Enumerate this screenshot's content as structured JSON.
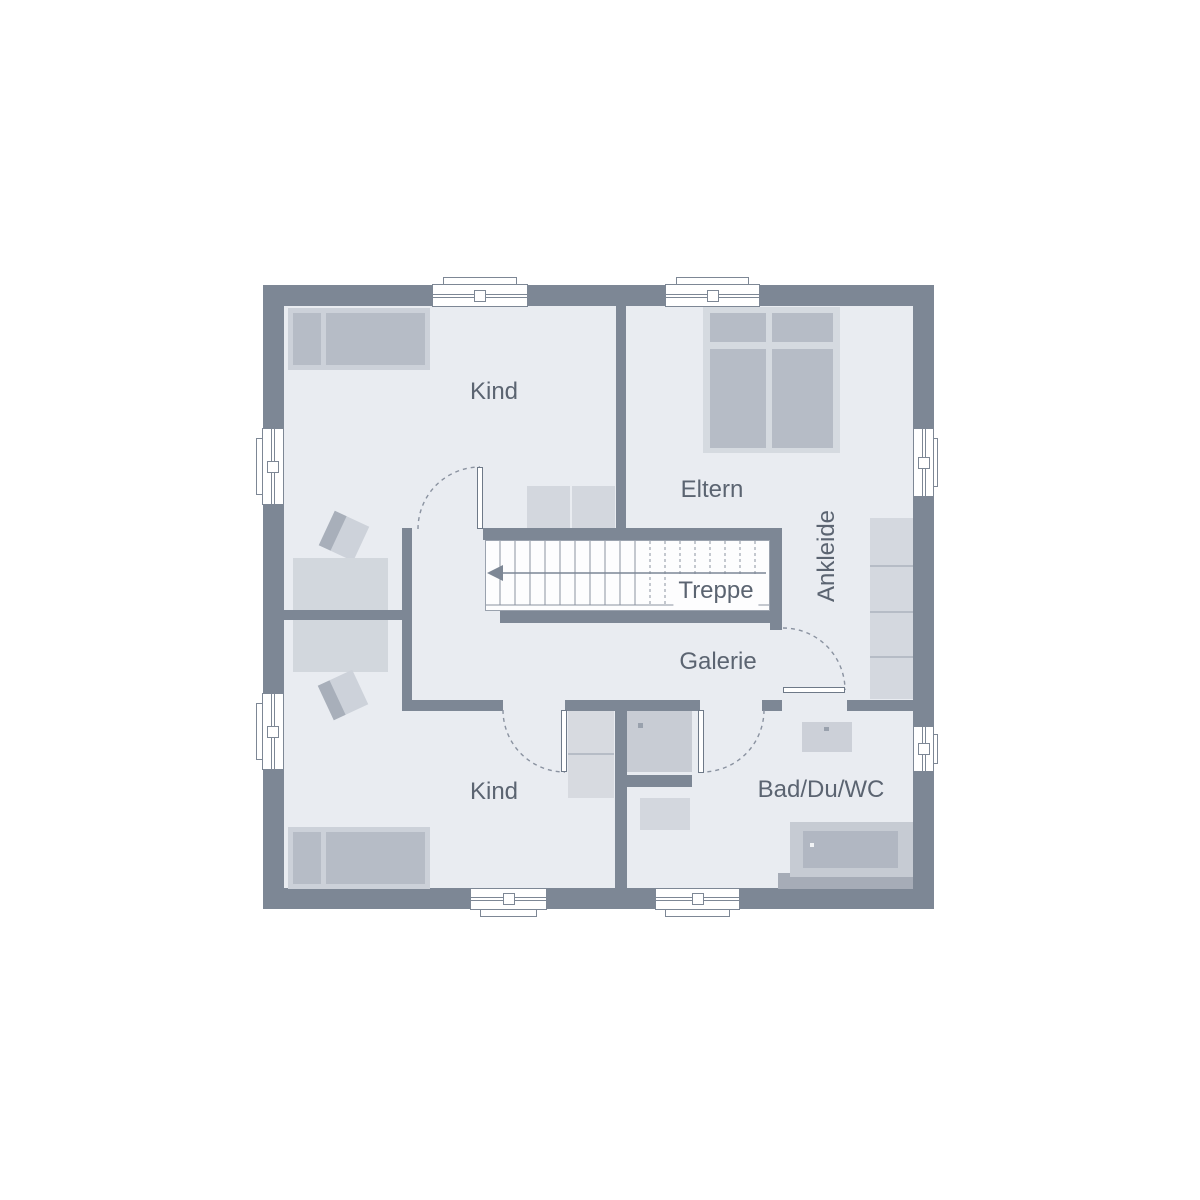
{
  "floor_plan": {
    "labels": {
      "kind_top": "Kind",
      "eltern": "Eltern",
      "ankleide": "Ankleide",
      "treppe": "Treppe",
      "galerie": "Galerie",
      "kind_bottom": "Kind",
      "bad": "Bad/Du/WC"
    },
    "colors": {
      "wall": "#7d8795",
      "floor": "#e9ecf1",
      "background": "#ffffff",
      "furniture_light": "#d3d7de",
      "furniture_dark": "#b6bcc6",
      "stair_fill": "#fdfdfe",
      "line": "#8a92a0",
      "text": "#5b6471"
    },
    "symbols": [
      "bed",
      "double-bed",
      "desk",
      "chair",
      "wardrobe",
      "shower",
      "wc",
      "washbasin",
      "bathtub",
      "stairs",
      "arrow-left",
      "door-swing",
      "window"
    ]
  }
}
